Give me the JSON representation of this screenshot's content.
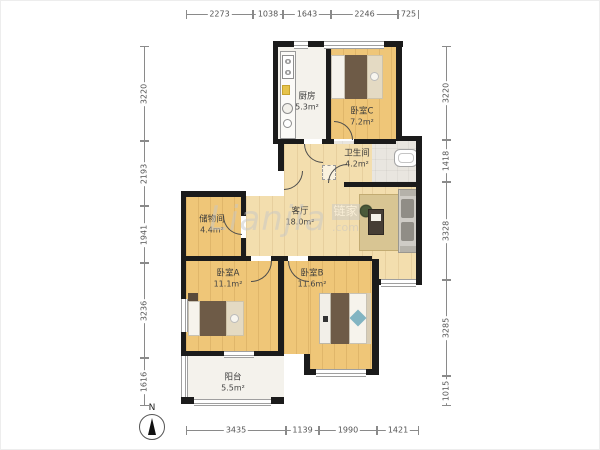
{
  "plan": {
    "rooms": [
      {
        "name": "厨房",
        "area": "5.3m²"
      },
      {
        "name": "卧室C",
        "area": "7.2m²"
      },
      {
        "name": "卫生间",
        "area": "4.2m²"
      },
      {
        "name": "客厅",
        "area": "18.0m²"
      },
      {
        "name": "储物间",
        "area": "4.4m²"
      },
      {
        "name": "卧室A",
        "area": "11.1m²"
      },
      {
        "name": "卧室B",
        "area": "11.6m²"
      },
      {
        "name": "阳台",
        "area": "5.5m²"
      }
    ],
    "dimensions": {
      "top": [
        "2273",
        "1038",
        "1643",
        "2246",
        "725"
      ],
      "bottom": [
        "3435",
        "1139",
        "1990",
        "1421"
      ],
      "left": [
        "3220",
        "2193",
        "1941",
        "3236",
        "1616"
      ],
      "right": [
        "3220",
        "1418",
        "3328",
        "3285",
        "1015"
      ]
    },
    "compass": {
      "label": "N"
    },
    "watermark": {
      "script": "Lianjia",
      "logo": "链家",
      "suffix": ".com"
    },
    "colors": {
      "wall": "#1b1b1b",
      "wood_floor": "#efc678",
      "living_floor": "#f3deae",
      "tile_floor": "#f4f2ec",
      "bath_floor": "#e9e6e0",
      "blanket_brown": "#6e5b47",
      "accent_teal": "#82b4c2"
    }
  }
}
